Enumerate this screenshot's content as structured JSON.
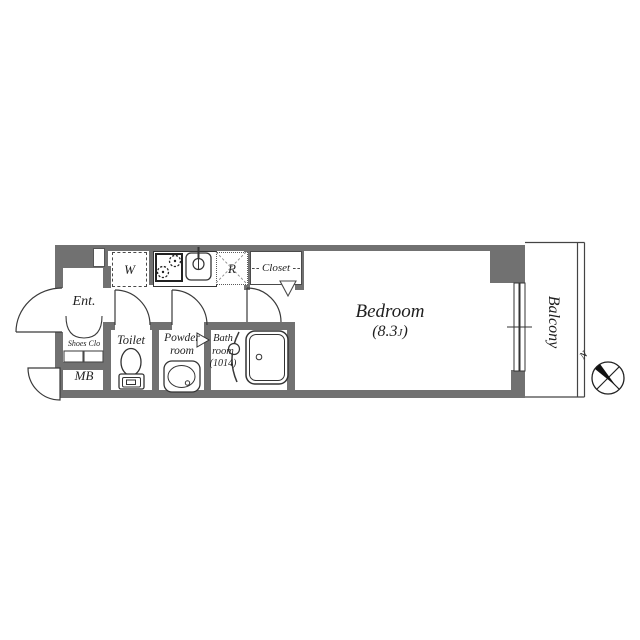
{
  "plan_title": "one-room apartment floor plan",
  "rooms": {
    "entrance": "Ent.",
    "shoes_closet": "Shoes Clo",
    "meter_box": "MB",
    "toilet": "Toilet",
    "powder_line1": "Powder",
    "powder_line2": "room",
    "bath_line1": "Bath",
    "bath_line2": "room",
    "bath_line3": "(1014)",
    "washer": "W",
    "refrigerator": "R",
    "closet": "Closet",
    "bedroom_name": "Bedroom",
    "bedroom_area_open": "(8.3",
    "bedroom_area_unit": "J",
    "bedroom_area_close": ")",
    "balcony": "Balcony",
    "north": "N"
  },
  "colors": {
    "wall": "#717171",
    "fixture_line": "#333333",
    "text": "#1f1f1f",
    "background": "#ffffff"
  }
}
